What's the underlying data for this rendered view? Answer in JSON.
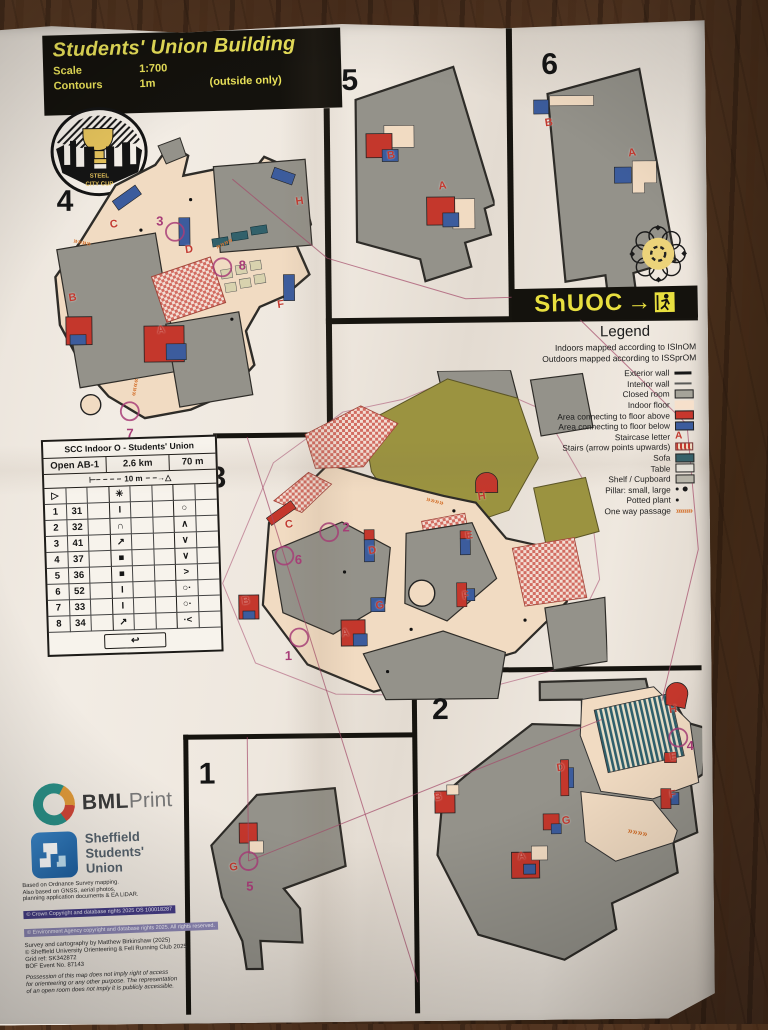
{
  "title_block": {
    "title": "Students' Union Building",
    "scale_label": "Scale",
    "scale_value": "1:700",
    "contours_label": "Contours",
    "contours_value": "1m",
    "contours_note": "(outside only)"
  },
  "logos": {
    "steel_city_cup": {
      "line1": "STEEL",
      "line2": "CITY CUP"
    },
    "shuoc": {
      "text": "ShUOC",
      "arrow": "→"
    },
    "bml": {
      "bold": "BML",
      "light": "Print"
    },
    "students_union": {
      "line1": "Sheffield",
      "line2": "Students'",
      "line3": "Union"
    }
  },
  "legend": {
    "title": "Legend",
    "intro1": "Indoors mapped according to ISInOM",
    "intro2": "Outdoors mapped according to ISSprOM",
    "items": [
      {
        "label": "Exterior wall"
      },
      {
        "label": "Interior wall"
      },
      {
        "label": "Closed room"
      },
      {
        "label": "Indoor floor"
      },
      {
        "label": "Area connecting to floor above"
      },
      {
        "label": "Area connecting to floor below"
      },
      {
        "label": "Staircase letter",
        "glyph": "A"
      },
      {
        "label": "Stairs (arrow points upwards)"
      },
      {
        "label": "Sofa"
      },
      {
        "label": "Table"
      },
      {
        "label": "Shelf / Cupboard"
      },
      {
        "label": "Pillar: small, large"
      },
      {
        "label": "Potted plant"
      },
      {
        "label": "One way passage",
        "glyph": "»»»»"
      }
    ]
  },
  "control_card": {
    "title": "SCC Indoor O - Students' Union",
    "course": "Open AB-1",
    "length": "2.6 km",
    "climb": "70 m",
    "dist_left": "⊢− − − −",
    "start_distance": "10 m",
    "dist_right": "− −→△",
    "start_symbol": "▷",
    "start_feature": "✳",
    "rows": [
      {
        "num": "1",
        "code": "31",
        "col_d": "I",
        "col_g": "○"
      },
      {
        "num": "2",
        "code": "32",
        "col_d": "∩",
        "col_g": "∧"
      },
      {
        "num": "3",
        "code": "41",
        "col_d": "↗",
        "col_g": "∨"
      },
      {
        "num": "4",
        "code": "37",
        "col_d": "■",
        "col_g": "∨"
      },
      {
        "num": "5",
        "code": "36",
        "col_d": "■",
        "col_g": ">"
      },
      {
        "num": "6",
        "code": "52",
        "col_d": "I",
        "col_g": "○·"
      },
      {
        "num": "7",
        "code": "33",
        "col_d": "I",
        "col_g": "○·"
      },
      {
        "num": "8",
        "code": "34",
        "col_d": "↗",
        "col_g": "·<"
      }
    ],
    "finish_symbol": "↩"
  },
  "map_symbols": {
    "one_way": "»»»»"
  },
  "map_sections": {
    "s1": {
      "number": "1",
      "staircases": [
        "G"
      ],
      "controls": [
        "5"
      ]
    },
    "s2": {
      "number": "2",
      "staircases": [
        "H",
        "E",
        "F",
        "D",
        "G",
        "B",
        "A"
      ],
      "controls": [
        "4"
      ]
    },
    "s3": {
      "number": "3",
      "staircases": [
        "H",
        "E",
        "C",
        "D",
        "B",
        "F",
        "G",
        "A"
      ],
      "controls": [
        "2",
        "6",
        "1"
      ]
    },
    "s4": {
      "number": "4",
      "staircases": [
        "C",
        "D",
        "H",
        "F",
        "B",
        "A"
      ],
      "controls": [
        "3",
        "8",
        "7"
      ]
    },
    "s5": {
      "number": "5",
      "staircases": [
        "B",
        "A"
      ],
      "controls": []
    },
    "s6": {
      "number": "6",
      "staircases": [
        "B",
        "A"
      ],
      "controls": []
    }
  },
  "credits": {
    "based1": "Based on Ordnance Survey mapping.",
    "based2": "Also based on GNSS, aerial photos,",
    "based3": "planning application documents & EA LiDAR.",
    "crown": "© Crown Copyright and database rights 2025 OS 100018287",
    "ea": "© Environment Agency copyright and database rights 2025. All rights reserved.",
    "survey": "Survey and cartography by Matthew Birkinshaw (2025)",
    "club": "© Sheffield University Orienteering & Fell Running Club 2025",
    "grid": "Grid ref: SK342872",
    "bof": "BOF Event No. 87143",
    "possession1": "Possession of this map does not imply right of access",
    "possession2": "for orienteering or any other purpose. The representation",
    "possession3": "of an open room does not imply it is publicly accessible."
  },
  "colors": {
    "closed_room": "#94928a",
    "indoor_floor": "#f1dbc2",
    "floor_above": "#c4372c",
    "floor_below": "#3c5c9d",
    "sofa": "#32616b",
    "course_purple": "#a83d78",
    "staircase_letter_red": "#c23a30",
    "one_way_orange": "#d4722e",
    "banner_yellow": "#e8df3f",
    "outdoor_olive": "#9b9340"
  }
}
